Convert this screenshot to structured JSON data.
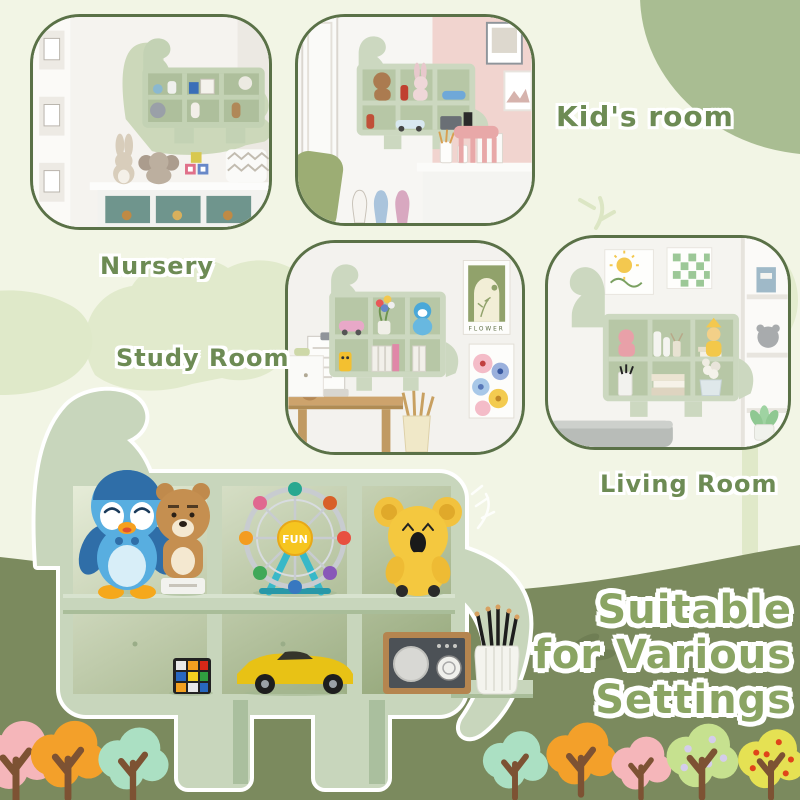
{
  "banner": {
    "photo_labels": {
      "nursery": "Nursery",
      "kids_room": "Kid's room",
      "study_room": "Study Room",
      "living_room": "Living Room"
    },
    "headline": {
      "line1": "Suitable",
      "line2": "for Various",
      "line3": "Settings"
    },
    "product_shelf": {
      "ferris_wheel_text": "FUN",
      "items": [
        "penguin-plush",
        "bear-figurine",
        "ferris-wheel-toy",
        "koala-plush",
        "rubiks-cube",
        "toy-sports-car",
        "retro-radio",
        "pencil-holder"
      ]
    },
    "study_poster_text": "FLOWER",
    "colors": {
      "background": "#f2f5e5",
      "ground": "#7b8a5e",
      "shelf": "#c8d6bc",
      "photo_border": "#5a7147",
      "label_text": "#6d8b54",
      "headline_text": "#8aa463",
      "corner_blob": "#a9bd92"
    },
    "trees": [
      {
        "name": "pink-tree",
        "color": "#f5b6ba"
      },
      {
        "name": "orange-tree",
        "color": "#f3a02a"
      },
      {
        "name": "mint-tree",
        "color": "#abe0c3"
      },
      {
        "name": "mint-tree",
        "color": "#abe0c3"
      },
      {
        "name": "orange-tree",
        "color": "#f3a02a"
      },
      {
        "name": "pink-tree",
        "color": "#f5b6ba"
      },
      {
        "name": "dotted-green-tree",
        "color": "#c6e18f"
      },
      {
        "name": "dotted-yellow-tree",
        "color": "#e5e153"
      }
    ]
  }
}
